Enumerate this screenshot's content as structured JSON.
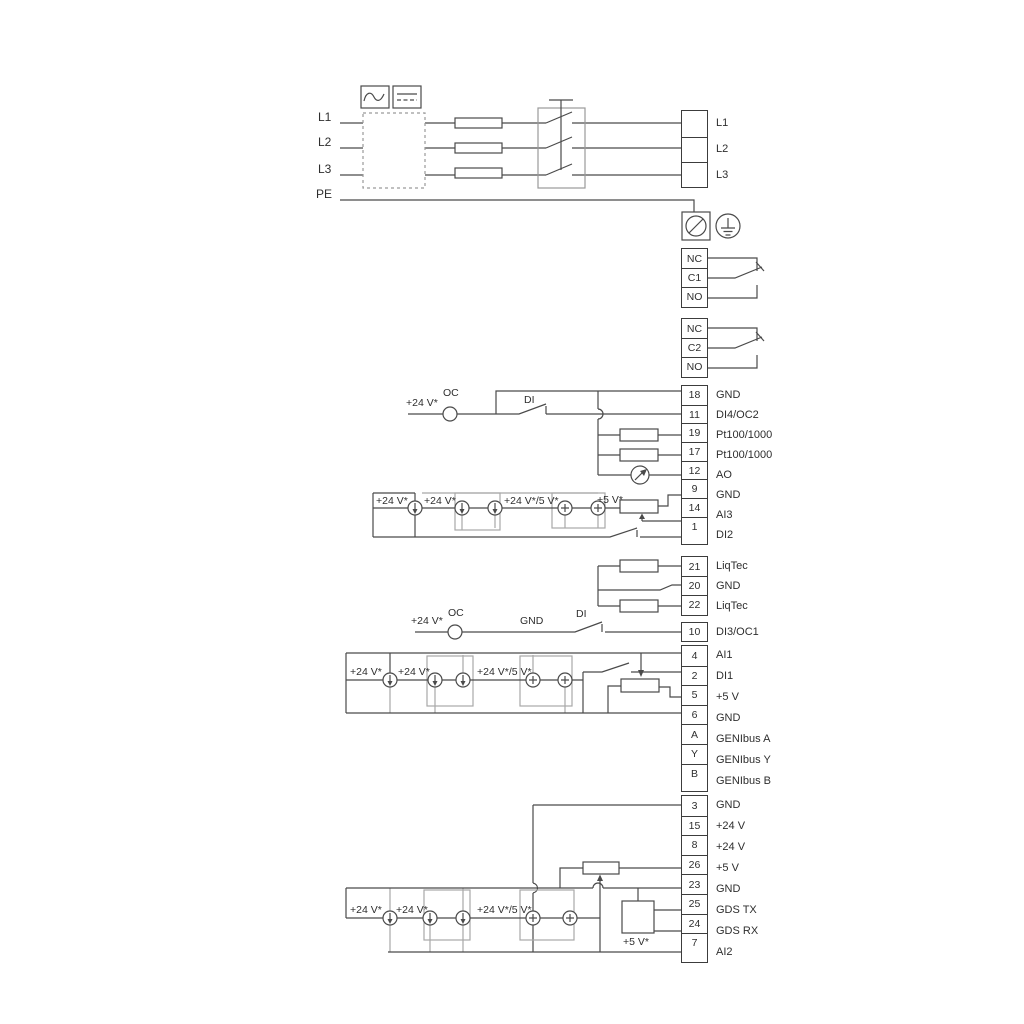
{
  "colors": {
    "line": "#4a4a4a",
    "gray": "#a8a8a8",
    "text": "#2e2e2e"
  },
  "power_in": {
    "l1": "L1",
    "l2": "L2",
    "l3": "L3",
    "pe": "PE"
  },
  "mains_out": {
    "rows": [
      {
        "label": "L1"
      },
      {
        "label": "L2"
      },
      {
        "label": "L3"
      }
    ]
  },
  "relay1": {
    "cells": [
      "NC",
      "C1",
      "NO"
    ]
  },
  "relay2": {
    "cells": [
      "NC",
      "C2",
      "NO"
    ]
  },
  "io1": {
    "rows": [
      {
        "n": "18",
        "label": "GND"
      },
      {
        "n": "11",
        "label": "DI4/OC2"
      },
      {
        "n": "19",
        "label": "Pt100/1000"
      },
      {
        "n": "17",
        "label": "Pt100/1000"
      },
      {
        "n": "12",
        "label": "AO"
      },
      {
        "n": "9",
        "label": "GND"
      },
      {
        "n": "14",
        "label": "AI3"
      },
      {
        "n": "1",
        "label": "DI2"
      }
    ]
  },
  "liqtec": {
    "rows": [
      {
        "n": "21",
        "label": "LiqTec"
      },
      {
        "n": "20",
        "label": "GND"
      },
      {
        "n": "22",
        "label": "LiqTec"
      }
    ]
  },
  "di3": {
    "rows": [
      {
        "n": "10",
        "label": "DI3/OC1"
      }
    ]
  },
  "io2": {
    "rows": [
      {
        "n": "4",
        "label": "AI1"
      },
      {
        "n": "2",
        "label": "DI1"
      },
      {
        "n": "5",
        "label": "+5 V"
      },
      {
        "n": "6",
        "label": "GND"
      },
      {
        "n": "A",
        "label": "GENIbus A"
      },
      {
        "n": "Y",
        "label": "GENIbus Y"
      },
      {
        "n": "B",
        "label": "GENIbus B"
      }
    ]
  },
  "io3": {
    "rows": [
      {
        "n": "3",
        "label": "GND"
      },
      {
        "n": "15",
        "label": "+24 V"
      },
      {
        "n": "8",
        "label": "+24 V"
      },
      {
        "n": "26",
        "label": "+5 V"
      },
      {
        "n": "23",
        "label": "GND"
      },
      {
        "n": "25",
        "label": "GDS TX"
      },
      {
        "n": "24",
        "label": "GDS RX"
      },
      {
        "n": "7",
        "label": "AI2"
      }
    ]
  },
  "annotations": {
    "v24": "+24 V*",
    "v24_5": "+24 V*/5 V*",
    "v5": "+5 V*",
    "oc": "OC",
    "di": "DI",
    "gnd": "GND"
  }
}
